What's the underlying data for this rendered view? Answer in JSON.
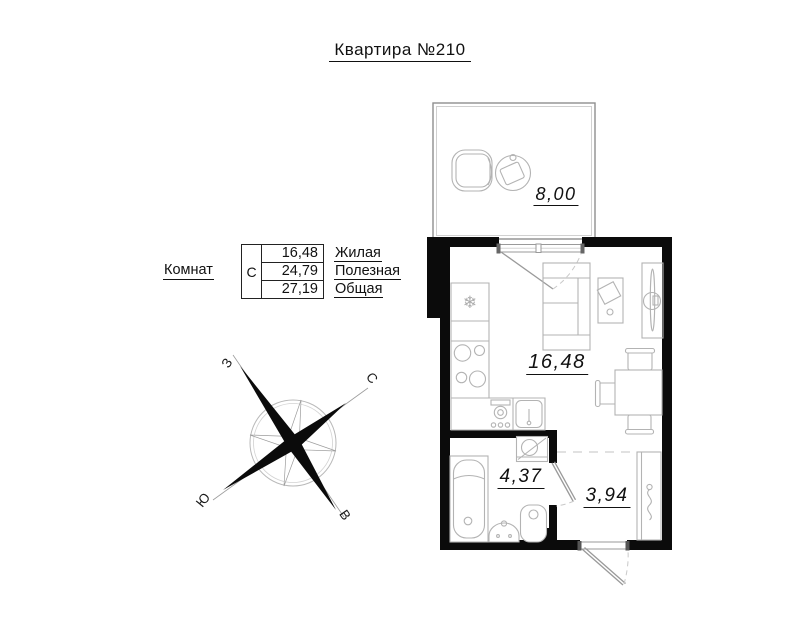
{
  "title": "Квартира №210",
  "legend": {
    "rooms_label": "Комнат",
    "type_code": "С",
    "rows": [
      {
        "value": "16,48",
        "label": "Жилая"
      },
      {
        "value": "24,79",
        "label": "Полезная"
      },
      {
        "value": "27,19",
        "label": "Общая"
      }
    ]
  },
  "compass": {
    "west": "З",
    "north": "С",
    "south": "Ю",
    "east": "В"
  },
  "rooms": {
    "balcony": {
      "area": "8,00"
    },
    "living": {
      "area": "16,48"
    },
    "bathroom": {
      "area": "4,37"
    },
    "hallway": {
      "area": "3,94"
    }
  },
  "icons": {
    "fridge": "❄"
  },
  "colors": {
    "wall": "#0b0b0b",
    "furniture_line": "#b3b3b3",
    "text": "#111111"
  }
}
